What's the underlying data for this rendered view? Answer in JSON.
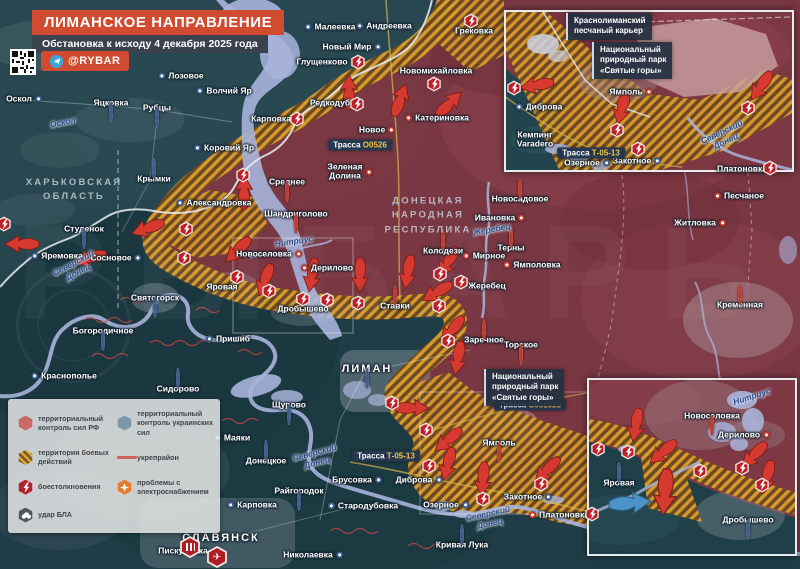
{
  "meta": {
    "title": "ЛИМАНСКОЕ НАПРАВЛЕНИЕ",
    "subtitle": "Обстановка к исходу 4 декабря 2025 года",
    "handle": "@RYBAR",
    "watermark": "РЫБАРЬ"
  },
  "colors": {
    "accent_red": "#d14b30",
    "panel_dark": "#39424d",
    "ru_area": "#7e3742",
    "ua_area": "#20424d",
    "combat_hatch": "#dc9e2c",
    "water": "#a9b4dc",
    "badge_code": "#f0c43c",
    "clash_red": "#bf1f26"
  },
  "legend": {
    "items": [
      {
        "icon": "hex-rf",
        "label": "территориальный контроль сил РФ"
      },
      {
        "icon": "hex-ua",
        "label": "территориальный контроль украинских сил"
      },
      {
        "icon": "hex-combat",
        "label": "территория боевых действий"
      },
      {
        "icon": "line-fort",
        "label": "укрепрайон"
      },
      {
        "icon": "hex-clash",
        "label": "боестолкновения"
      },
      {
        "icon": "hex-power",
        "label": "проблемы с электроснабжением"
      },
      {
        "icon": "hex-drone",
        "label": "удар БЛА"
      }
    ]
  },
  "map": {
    "regions": [
      {
        "t": "ХАРЬКОВСКАЯ\nОБЛАСТЬ",
        "x": 74,
        "y": 190
      },
      {
        "t": "ДОНЕЦКАЯ\nНАРОДНАЯ\nРЕСПУБЛИКА",
        "x": 428,
        "y": 216
      }
    ],
    "rivers": [
      {
        "t": "Оскол",
        "x": 63,
        "y": 123,
        "r": -12
      },
      {
        "t": "Северский\nДонец",
        "x": 76,
        "y": 268,
        "r": -28
      },
      {
        "t": "Нитриус",
        "x": 294,
        "y": 242,
        "r": -8
      },
      {
        "t": "Жеребец",
        "x": 492,
        "y": 230,
        "r": -10
      },
      {
        "t": "Северский\nДонец",
        "x": 316,
        "y": 458,
        "r": -15
      },
      {
        "t": "Северский\nДонец",
        "x": 489,
        "y": 519,
        "r": -12
      },
      {
        "t": "Северский\nДонец",
        "x": 724,
        "y": 137,
        "r": -25
      },
      {
        "t": "Нитриус",
        "x": 752,
        "y": 397,
        "r": -18
      }
    ],
    "towns": [
      {
        "t": "Малеевка",
        "x": 330,
        "y": 27,
        "d": "ua",
        "s": "l"
      },
      {
        "t": "Андреевка",
        "x": 384,
        "y": 26,
        "d": "ua",
        "s": "l"
      },
      {
        "t": "Грековка",
        "x": 474,
        "y": 31
      },
      {
        "t": "Новый Мир",
        "x": 352,
        "y": 47,
        "d": "ua",
        "s": "r"
      },
      {
        "t": "Глущенково",
        "x": 322,
        "y": 62
      },
      {
        "t": "Новомихайловка",
        "x": 436,
        "y": 71
      },
      {
        "t": "Лозовое",
        "x": 181,
        "y": 76,
        "d": "ua",
        "s": "l"
      },
      {
        "t": "Волчий Яр",
        "x": 224,
        "y": 91,
        "d": "ua",
        "s": "l"
      },
      {
        "t": "Оскол",
        "x": 24,
        "y": 99,
        "d": "ua",
        "s": "r"
      },
      {
        "t": "Яцковка",
        "x": 111,
        "y": 103,
        "d": "ua",
        "s": "b"
      },
      {
        "t": "Рубцы",
        "x": 157,
        "y": 108,
        "d": "ua",
        "s": "b"
      },
      {
        "t": "Редкодуб",
        "x": 330,
        "y": 103
      },
      {
        "t": "Карповка",
        "x": 271,
        "y": 119
      },
      {
        "t": "Катериновка",
        "x": 437,
        "y": 118,
        "d": "ru",
        "s": "l"
      },
      {
        "t": "Новое",
        "x": 377,
        "y": 130,
        "d": "ru",
        "s": "r"
      },
      {
        "t": "Коровий Яр",
        "x": 224,
        "y": 148,
        "d": "ua",
        "s": "l"
      },
      {
        "t": "Зеленая Долина",
        "lines": [
          "Зеленая",
          "Долина"
        ],
        "x": 350,
        "y": 172,
        "d": "ru",
        "s": "r"
      },
      {
        "t": "Среднее",
        "x": 287,
        "y": 182,
        "d": "ru",
        "s": "b"
      },
      {
        "t": "Крымки",
        "x": 154,
        "y": 179,
        "d": "ua",
        "s": "a"
      },
      {
        "t": "Александровка",
        "x": 214,
        "y": 203,
        "d": "ua",
        "s": "l"
      },
      {
        "t": "Шандриголово",
        "x": 296,
        "y": 214,
        "d": "ru",
        "s": "b"
      },
      {
        "t": "Студенок",
        "x": 84,
        "y": 229,
        "d": "ua",
        "s": "b"
      },
      {
        "t": "Новоселовка",
        "x": 269,
        "y": 254,
        "d": "ru",
        "s": "r"
      },
      {
        "t": "Яремовка",
        "x": 57,
        "y": 256,
        "d": "ua",
        "s": "l"
      },
      {
        "t": "Сосновое",
        "x": 116,
        "y": 258,
        "d": "ua",
        "s": "r"
      },
      {
        "t": "Дерилово",
        "x": 327,
        "y": 268,
        "d": "ru",
        "s": "l"
      },
      {
        "t": "Колодези",
        "x": 443,
        "y": 251,
        "d": "ru",
        "s": "a"
      },
      {
        "t": "Мирное",
        "x": 484,
        "y": 256,
        "d": "ru",
        "s": "l"
      },
      {
        "t": "Ямполовка",
        "x": 532,
        "y": 265,
        "d": "ru",
        "s": "l"
      },
      {
        "t": "Терны",
        "x": 511,
        "y": 248,
        "d": "ru",
        "s": "a"
      },
      {
        "t": "Ивановка",
        "x": 500,
        "y": 218,
        "d": "ru",
        "s": "r"
      },
      {
        "t": "Новосадовое",
        "x": 520,
        "y": 199,
        "d": "ru",
        "s": "a"
      },
      {
        "t": "Жеребец",
        "x": 487,
        "y": 286
      },
      {
        "t": "Яровая",
        "x": 222,
        "y": 287
      },
      {
        "t": "Дробышево",
        "x": 303,
        "y": 309
      },
      {
        "t": "Ставки",
        "x": 395,
        "y": 306,
        "d": "ru",
        "s": "a"
      },
      {
        "t": "Святогорск",
        "x": 155,
        "y": 298,
        "d": "ua",
        "s": "b"
      },
      {
        "t": "Богородичное",
        "x": 103,
        "y": 331,
        "d": "ua",
        "s": "b"
      },
      {
        "t": "Пришиб",
        "x": 228,
        "y": 339,
        "d": "ua",
        "s": "l"
      },
      {
        "t": "Заречное",
        "x": 484,
        "y": 340,
        "d": "ru",
        "s": "a"
      },
      {
        "t": "Торское",
        "x": 521,
        "y": 345,
        "d": "ru",
        "s": "b"
      },
      {
        "t": "ЛИМАН",
        "x": 367,
        "y": 369,
        "d": "ua",
        "s": "b",
        "city": 1
      },
      {
        "t": "Краснополье",
        "x": 64,
        "y": 376,
        "d": "ua",
        "s": "l"
      },
      {
        "t": "Сидорово",
        "x": 178,
        "y": 389,
        "d": "ua",
        "s": "a"
      },
      {
        "t": "Щурово",
        "x": 289,
        "y": 405,
        "d": "ua",
        "s": "b"
      },
      {
        "t": "Житловка",
        "x": 700,
        "y": 223,
        "d": "ru",
        "s": "r"
      },
      {
        "t": "Песчаное",
        "x": 739,
        "y": 196,
        "d": "ru",
        "s": "l"
      },
      {
        "t": "Кременная",
        "x": 740,
        "y": 305,
        "d": "ru",
        "s": "a"
      },
      {
        "t": "Ямполь",
        "x": 499,
        "y": 443,
        "d": "ru",
        "s": "b"
      },
      {
        "t": "Диброва",
        "x": 419,
        "y": 480,
        "d": "ua",
        "s": "r"
      },
      {
        "t": "Озерное",
        "x": 446,
        "y": 505,
        "d": "ua",
        "s": "r"
      },
      {
        "t": "Закотное",
        "x": 528,
        "y": 497,
        "d": "ua",
        "s": "r"
      },
      {
        "t": "Платоновка",
        "x": 559,
        "y": 515,
        "d": "ru",
        "s": "l"
      },
      {
        "t": "Маяки",
        "x": 232,
        "y": 438,
        "d": "ua",
        "s": "l"
      },
      {
        "t": "Донецкое",
        "x": 266,
        "y": 461,
        "d": "ua",
        "s": "a"
      },
      {
        "t": "Брусовка",
        "x": 357,
        "y": 480,
        "d": "ua",
        "s": "r"
      },
      {
        "t": "Райгородок",
        "x": 299,
        "y": 491,
        "d": "ua",
        "s": "b"
      },
      {
        "t": "Карповка",
        "x": 252,
        "y": 505,
        "d": "ua",
        "s": "l"
      },
      {
        "t": "Стародубовка",
        "x": 363,
        "y": 506,
        "d": "ua",
        "s": "l"
      },
      {
        "t": "Пискуновка",
        "x": 188,
        "y": 551,
        "d": "ua",
        "s": "r"
      },
      {
        "t": "СЛАВЯНСК",
        "x": 221,
        "y": 538,
        "city": 1
      },
      {
        "t": "Николаевка",
        "x": 313,
        "y": 555,
        "d": "ua",
        "s": "r"
      },
      {
        "t": "Кривая Лука",
        "x": 462,
        "y": 545,
        "d": "ua",
        "s": "a"
      },
      {
        "t": "Ямполь",
        "x": 631,
        "y": 92,
        "d": "ru",
        "s": "r"
      },
      {
        "t": "Диброва",
        "x": 539,
        "y": 107,
        "d": "ua",
        "s": "l"
      },
      {
        "t": "Кемпинг Varadero",
        "lines": [
          "Кемпинг",
          "Varadero"
        ],
        "x": 535,
        "y": 140
      },
      {
        "t": "Озерное",
        "x": 587,
        "y": 163,
        "d": "ua",
        "s": "r"
      },
      {
        "t": "Закотное",
        "x": 637,
        "y": 161,
        "d": "ua",
        "s": "r"
      },
      {
        "t": "Платоновка",
        "x": 742,
        "y": 169
      },
      {
        "t": "Новоселовка",
        "x": 712,
        "y": 416,
        "d": "ru",
        "s": "b"
      },
      {
        "t": "Дерилово",
        "x": 744,
        "y": 435,
        "d": "ru",
        "s": "r"
      },
      {
        "t": "Яровая",
        "x": 619,
        "y": 483,
        "d": "ua",
        "s": "a"
      },
      {
        "t": "Дробышево",
        "x": 748,
        "y": 520,
        "d": "ua",
        "s": "b"
      }
    ],
    "clashes": [
      [
        471,
        21
      ],
      [
        358,
        62
      ],
      [
        434,
        84
      ],
      [
        357,
        104
      ],
      [
        297,
        119
      ],
      [
        243,
        175
      ],
      [
        4,
        224
      ],
      [
        186,
        229
      ],
      [
        184,
        258
      ],
      [
        237,
        277
      ],
      [
        269,
        291
      ],
      [
        303,
        299
      ],
      [
        327,
        300
      ],
      [
        358,
        303
      ],
      [
        440,
        274
      ],
      [
        439,
        306
      ],
      [
        461,
        282
      ],
      [
        448,
        341
      ],
      [
        392,
        403
      ],
      [
        426,
        430
      ],
      [
        429,
        466
      ],
      [
        483,
        499
      ],
      [
        541,
        484
      ],
      [
        592,
        514
      ],
      [
        514,
        88
      ],
      [
        748,
        108
      ],
      [
        617,
        130
      ],
      [
        638,
        149
      ],
      [
        770,
        168
      ],
      [
        598,
        449
      ],
      [
        628,
        452
      ],
      [
        700,
        471
      ],
      [
        742,
        468
      ],
      [
        762,
        485
      ]
    ],
    "strikes": [
      {
        "x": 190,
        "y": 547,
        "glyph": "bars"
      },
      {
        "x": 217,
        "y": 557,
        "glyph": "jet"
      }
    ],
    "arrows": [
      {
        "x": 349,
        "y": 92,
        "r": 180
      },
      {
        "x": 400,
        "y": 100,
        "r": 200
      },
      {
        "x": 449,
        "y": 104,
        "r": 225
      },
      {
        "x": 244,
        "y": 192,
        "r": 180
      },
      {
        "x": 148,
        "y": 228,
        "r": 70
      },
      {
        "x": 22,
        "y": 244,
        "r": 90
      },
      {
        "x": 90,
        "y": 258,
        "r": 75
      },
      {
        "x": 238,
        "y": 250,
        "r": 45
      },
      {
        "x": 265,
        "y": 280,
        "r": 20
      },
      {
        "x": 312,
        "y": 275,
        "r": 10
      },
      {
        "x": 360,
        "y": 275,
        "r": 0
      },
      {
        "x": 408,
        "y": 272,
        "r": 10
      },
      {
        "x": 448,
        "y": 262,
        "r": 30
      },
      {
        "x": 437,
        "y": 292,
        "r": 60
      },
      {
        "x": 452,
        "y": 330,
        "r": 40
      },
      {
        "x": 458,
        "y": 358,
        "r": 10
      },
      {
        "x": 412,
        "y": 408,
        "r": 270
      },
      {
        "x": 448,
        "y": 440,
        "r": 50
      },
      {
        "x": 448,
        "y": 464,
        "r": 15
      },
      {
        "x": 483,
        "y": 479,
        "r": 5
      },
      {
        "x": 547,
        "y": 470,
        "r": 45
      },
      {
        "x": 537,
        "y": 85,
        "r": 80
      },
      {
        "x": 622,
        "y": 108,
        "r": 15
      },
      {
        "x": 761,
        "y": 86,
        "r": 35
      },
      {
        "x": 636,
        "y": 425,
        "r": 10
      },
      {
        "x": 663,
        "y": 452,
        "r": 50
      },
      {
        "x": 754,
        "y": 455,
        "r": 45
      },
      {
        "x": 767,
        "y": 477,
        "r": 15
      },
      {
        "x": 665,
        "y": 492,
        "r": 5,
        "s": 1.15
      },
      {
        "x": 630,
        "y": 503,
        "r": 265,
        "s": 1.05,
        "c": "blue"
      }
    ],
    "roads": [
      {
        "pre": "Трасса",
        "code": "О0526",
        "x": 360,
        "y": 145
      },
      {
        "pre": "Трасса",
        "code": "Т-05-13",
        "x": 386,
        "y": 456
      },
      {
        "pre": "Трасса",
        "code": "С051023",
        "x": 530,
        "y": 405
      },
      {
        "pre": "Трасса",
        "code": "Т-05-13",
        "x": 591,
        "y": 153
      }
    ],
    "boxes": [
      {
        "lines": [
          "Краснолиманский",
          "песчаный карьер"
        ],
        "x": 566,
        "y": 13
      },
      {
        "lines": [
          "Национальный",
          "природный парк",
          "«Святые горы»"
        ],
        "x": 592,
        "y": 42
      },
      {
        "lines": [
          "Национальный",
          "природный парк",
          "«Святые горы»"
        ],
        "x": 484,
        "y": 369
      }
    ],
    "faint": [
      {
        "t": "Крестище",
        "x": 100,
        "y": 451
      },
      {
        "t": "Липлянское",
        "x": 55,
        "y": 484
      }
    ]
  }
}
